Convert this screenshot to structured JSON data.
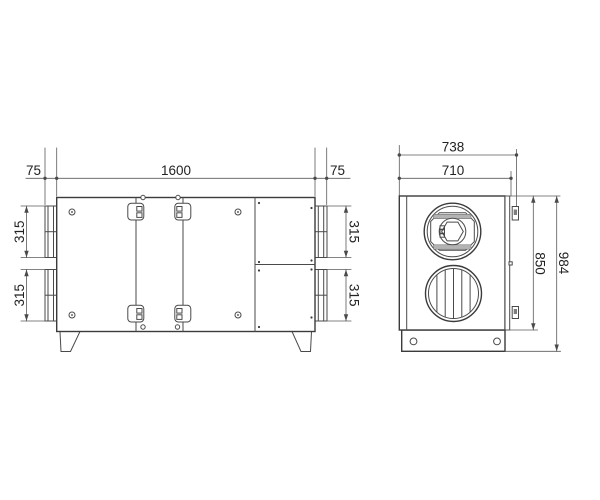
{
  "front_view": {
    "dims": {
      "left_overhang": "75",
      "body_width": "1600",
      "right_overhang": "75",
      "spigot_left_top": "315",
      "spigot_left_bottom": "315",
      "spigot_right_top": "315",
      "spigot_right_bottom": "315"
    }
  },
  "side_view": {
    "dims": {
      "overall_depth": "738",
      "body_depth": "710",
      "body_height": "850",
      "overall_height": "984"
    }
  },
  "colors": {
    "line": "#3b3b3b",
    "dim_line": "#5a5a5a",
    "text": "#222222",
    "background": "#ffffff"
  }
}
